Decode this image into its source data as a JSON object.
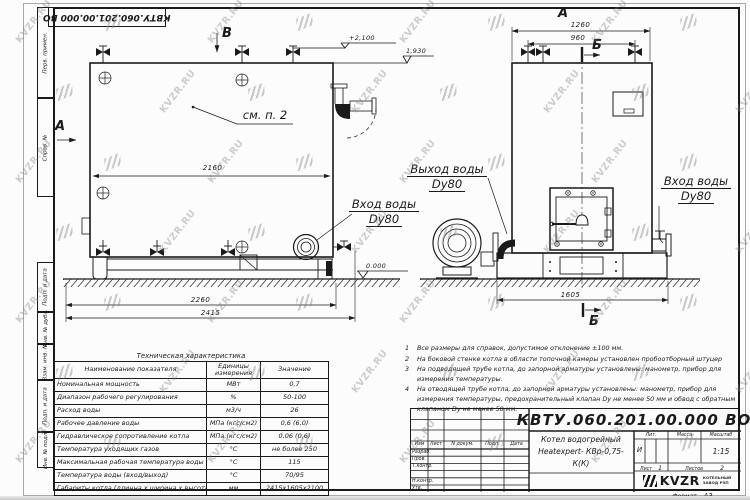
{
  "watermark": {
    "text": "KVZR.RU"
  },
  "stamp_top": {
    "doc_number": "КВТУ.060.201.00.000  ВО"
  },
  "margin_labels": {
    "l1": "Перв. примен.",
    "l2": "Справ. №",
    "l3": "Подп. и дата",
    "l4": "Инв. № дубл.",
    "l5": "Взам. инв. №",
    "l6": "Подп. и дата",
    "l7": "Инв. № подл."
  },
  "views": {
    "left": {
      "marker_a": "А",
      "marker_b": "В",
      "callout": "см. п. 2",
      "dim_inner": "2160",
      "dim_base": "2260",
      "dim_overall": "2415",
      "level_top": "+2,100",
      "level_shell": "1,930",
      "level_zero": "0.000",
      "inlet_line1": "Вход воды",
      "inlet_line2": "Dy80"
    },
    "right": {
      "marker_view": "А",
      "marker_section_top": "Б",
      "marker_section_bottom": "Б",
      "dim_outer": "1260",
      "dim_inner": "960",
      "dim_width": "1605",
      "outlet_line1": "Выход воды",
      "outlet_line2": "Dy80",
      "inlet_line1": "Вход воды",
      "inlet_line2": "Dy80"
    }
  },
  "notes": {
    "n1": {
      "num": "1",
      "text": "Все размеры для справок, допустимое отклонение ±100 мм."
    },
    "n2": {
      "num": "2",
      "text": "На боковой стенке котла в области топочной камеры установлен пробоотборный штуцер"
    },
    "n3": {
      "num": "3",
      "text": "На  подводящей трубе котла, до запорной арматуры установлены: манометр, прибор для измерения температуры."
    },
    "n4": {
      "num": "4",
      "text": "На отводящей трубе котла, до запорной арматуры установлены: манометр, прибор для измерения температуры, предохранительный клапан Dу не менее 50 мм и обвод с обратным клапаном Dу не менее 50 мм."
    }
  },
  "spec_table": {
    "title": "Техническая характеристика",
    "col_name": "Наименование показателя",
    "col_unit": "Единицы измерения",
    "col_value": "Значение",
    "rows": [
      {
        "name": "Номинальная мощность",
        "unit": "МВт",
        "value": "0,7"
      },
      {
        "name": "Диапазон рабочего регулирования",
        "unit": "%",
        "value": "50-100"
      },
      {
        "name": "Расход воды",
        "unit": "м3/ч",
        "value": "26"
      },
      {
        "name": "Рабочее давление воды",
        "unit": "МПа (кгс/см2)",
        "value": "0,6 (6,0)"
      },
      {
        "name": "Гидравлическое сопротивление котла",
        "unit": "МПа (кгс/см2)",
        "value": "0,06 (0,6)"
      },
      {
        "name": "Температура уходящих газов",
        "unit": "°С",
        "value": "не более 250"
      },
      {
        "name": "Максимальная рабочая температура воды",
        "unit": "°С",
        "value": "115"
      },
      {
        "name": "Температура воды (вход/выход)",
        "unit": "°С",
        "value": "70/95"
      },
      {
        "name": "Габариты котла (длинна х ширина х высота)",
        "unit": "мм",
        "value": "2415x1605x2100"
      }
    ]
  },
  "title_block": {
    "doc_number": "КВТУ.060.201.00.000  ВО",
    "product_line1": "Котел водогрейный",
    "product_line2": "Heatexpert- КВр-0,75- К(К)",
    "cols": {
      "izm": "Изм",
      "list": "Лист",
      "ndoc": "N докум.",
      "podp": "Подп.",
      "data": "Дата"
    },
    "sign_rows": {
      "r1": "Разраб.",
      "r2": "Пров.",
      "r3": "Т.контр.",
      "r4": "Н.контр.",
      "r5": "Утв."
    },
    "lit_label": "Лит.",
    "mass_label": "Масса",
    "scale_label": "Масштаб",
    "lit_value": "И",
    "scale_value": "1:15",
    "sheet_label": "Лист",
    "sheet_value": "1",
    "sheets_label": "Листов",
    "sheets_value": "2",
    "brand": "KVZR",
    "brand_line1": "КОТЕЛЬНЫЙ",
    "brand_line2": "ЗАВОД РЭП",
    "format_label": "Формат",
    "format_value": "А3"
  }
}
